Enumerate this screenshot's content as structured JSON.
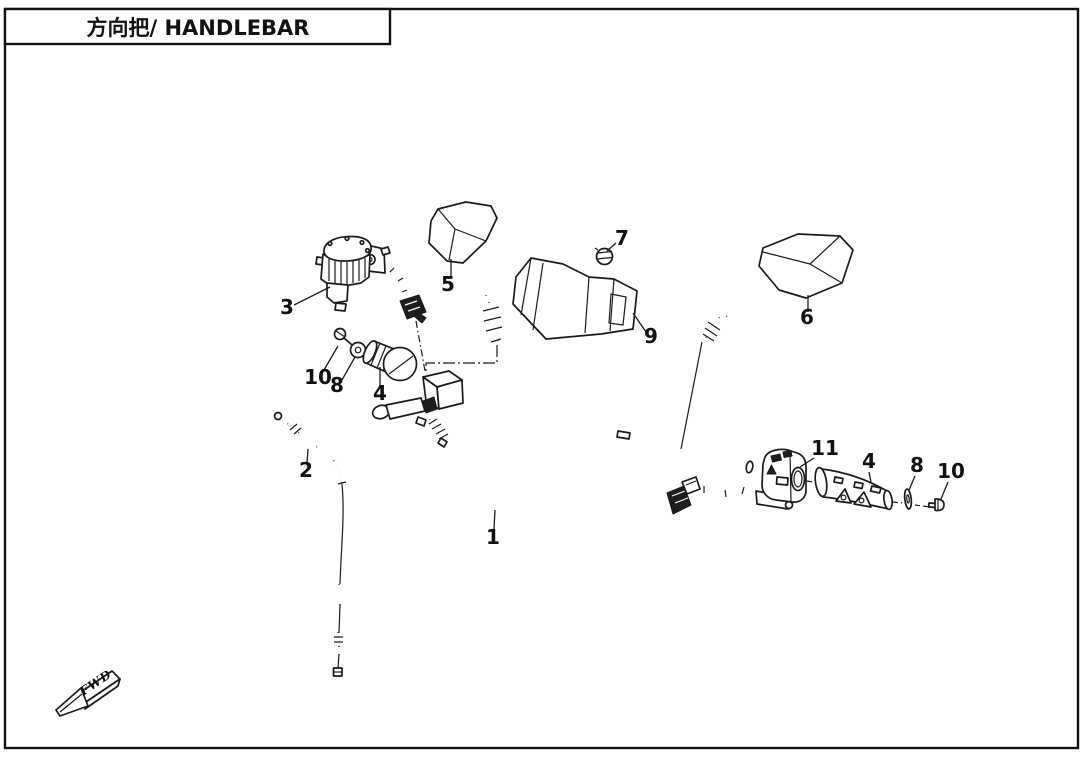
{
  "title": {
    "text": "方向把/ HANDLEBAR"
  },
  "fwd_label": "FWD",
  "callouts": [
    {
      "label": "1"
    },
    {
      "label": "2"
    },
    {
      "label": "3"
    },
    {
      "label": "4"
    },
    {
      "label": "5"
    },
    {
      "label": "6"
    },
    {
      "label": "7"
    },
    {
      "label": "8"
    },
    {
      "label": "9"
    },
    {
      "label": "10"
    },
    {
      "label": "11"
    }
  ],
  "colors": {
    "line": "#1a1a1a",
    "background": "#ffffff"
  }
}
